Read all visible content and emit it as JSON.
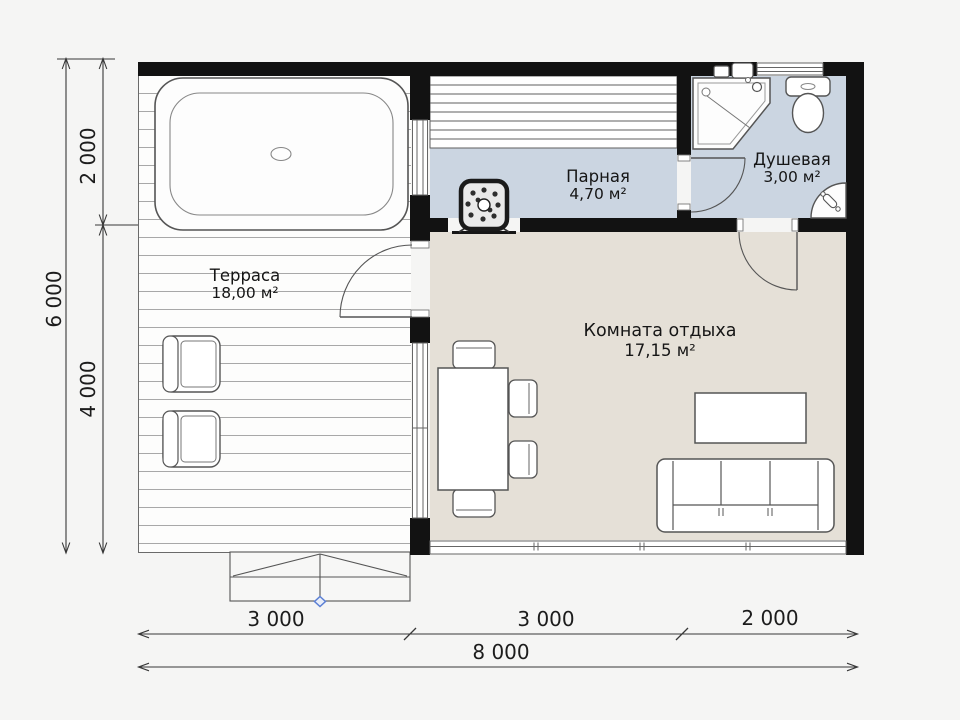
{
  "rooms": {
    "terrace": {
      "name": "Терраса",
      "area": "18,00 м²"
    },
    "steam": {
      "name": "Парная",
      "area": "4,70 м²"
    },
    "shower": {
      "name": "Душевая",
      "area": "3,00 м²"
    },
    "lounge": {
      "name": "Комната отдыха",
      "area": "17,15 м²"
    }
  },
  "dimensions": {
    "left_total": "6 000",
    "left_upper": "2 000",
    "left_lower": "4 000",
    "bottom_left": "3 000",
    "bottom_middle": "3 000",
    "bottom_right": "2 000",
    "bottom_total": "8 000"
  },
  "colors": {
    "wall": "#121212",
    "wet_room_fill": "#cbd5e1",
    "lounge_fill": "#e5e0d7",
    "terrace_deck_line": "#a8a8a8",
    "entry_marker": "#5b7fd4"
  },
  "fixtures": [
    "hot-tub",
    "armchair",
    "armchair",
    "sauna-benches",
    "sauna-stove",
    "shower-cabin",
    "toilet",
    "corner-sink",
    "dining-table",
    "dining-chairs",
    "coffee-table",
    "sofa",
    "entrance-steps",
    "entry-marker"
  ]
}
